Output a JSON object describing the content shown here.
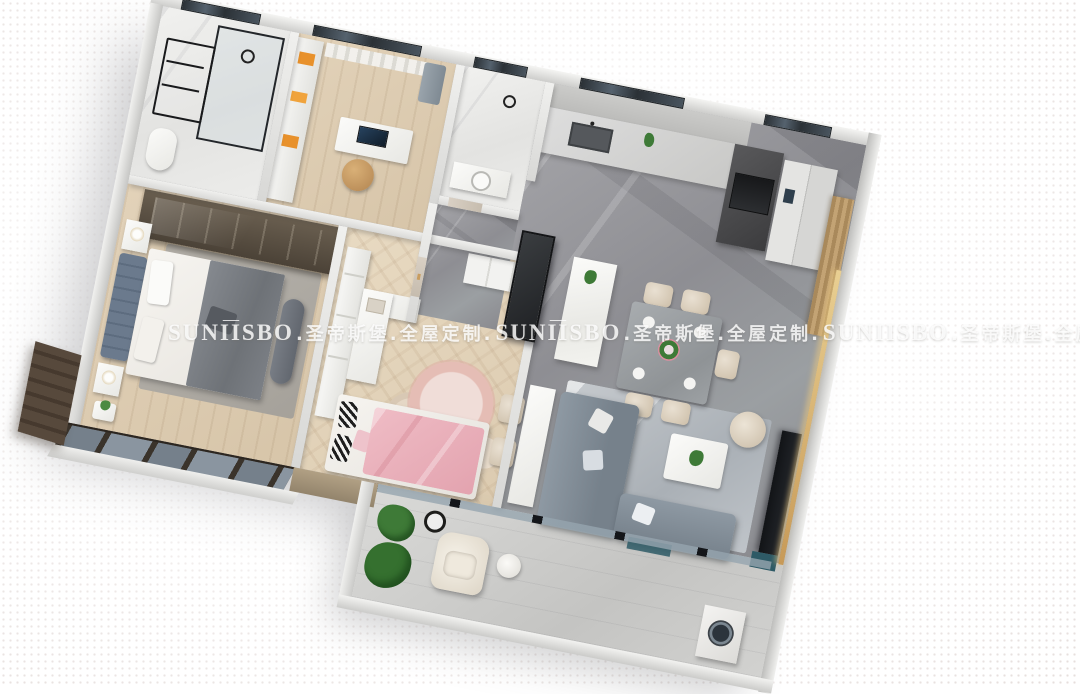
{
  "watermark": {
    "segments": [
      "SUNIISBO",
      ".圣帝斯堡.全屋定制.",
      "SUNIISBO",
      ".圣帝斯堡.全屋定制.",
      "SUNIISBO",
      ".圣帝斯堡.全屋定制.",
      "SUNIISBO"
    ],
    "brand_latin": "SUNIISBO",
    "brand_cjk": "圣帝斯堡",
    "tagline_cjk": "全屋定制",
    "crown_icon": "crown-icon",
    "color": "#ffffff",
    "opacity": 0.82
  },
  "scene": {
    "type": "3d-floorplan-render",
    "rooms": [
      "bathroom",
      "study",
      "guest-bathroom",
      "hallway",
      "kitchen",
      "dining-area",
      "living-room",
      "master-bedroom",
      "kids-bedroom",
      "balcony"
    ]
  },
  "palette": {
    "background": "#ffffff",
    "halftone_dot": "#d2c3be",
    "wall_light": "#f2f2f0",
    "wall_shadow": "#c9c9c7",
    "marble_gray_floor": "#95959a",
    "marble_white_floor": "#ececea",
    "wood_floor": "#dccbb0",
    "sofa_gray": "#808b95",
    "blanket_pink": "#e8b1ba",
    "rug_pink": "#ecc9c4",
    "chair_cream": "#d6c9b8",
    "wardrobe_dark": "#564c40",
    "window_glass": "#2b3136",
    "gold_led": "#c79a58",
    "plant_green": "#3e7a37"
  }
}
